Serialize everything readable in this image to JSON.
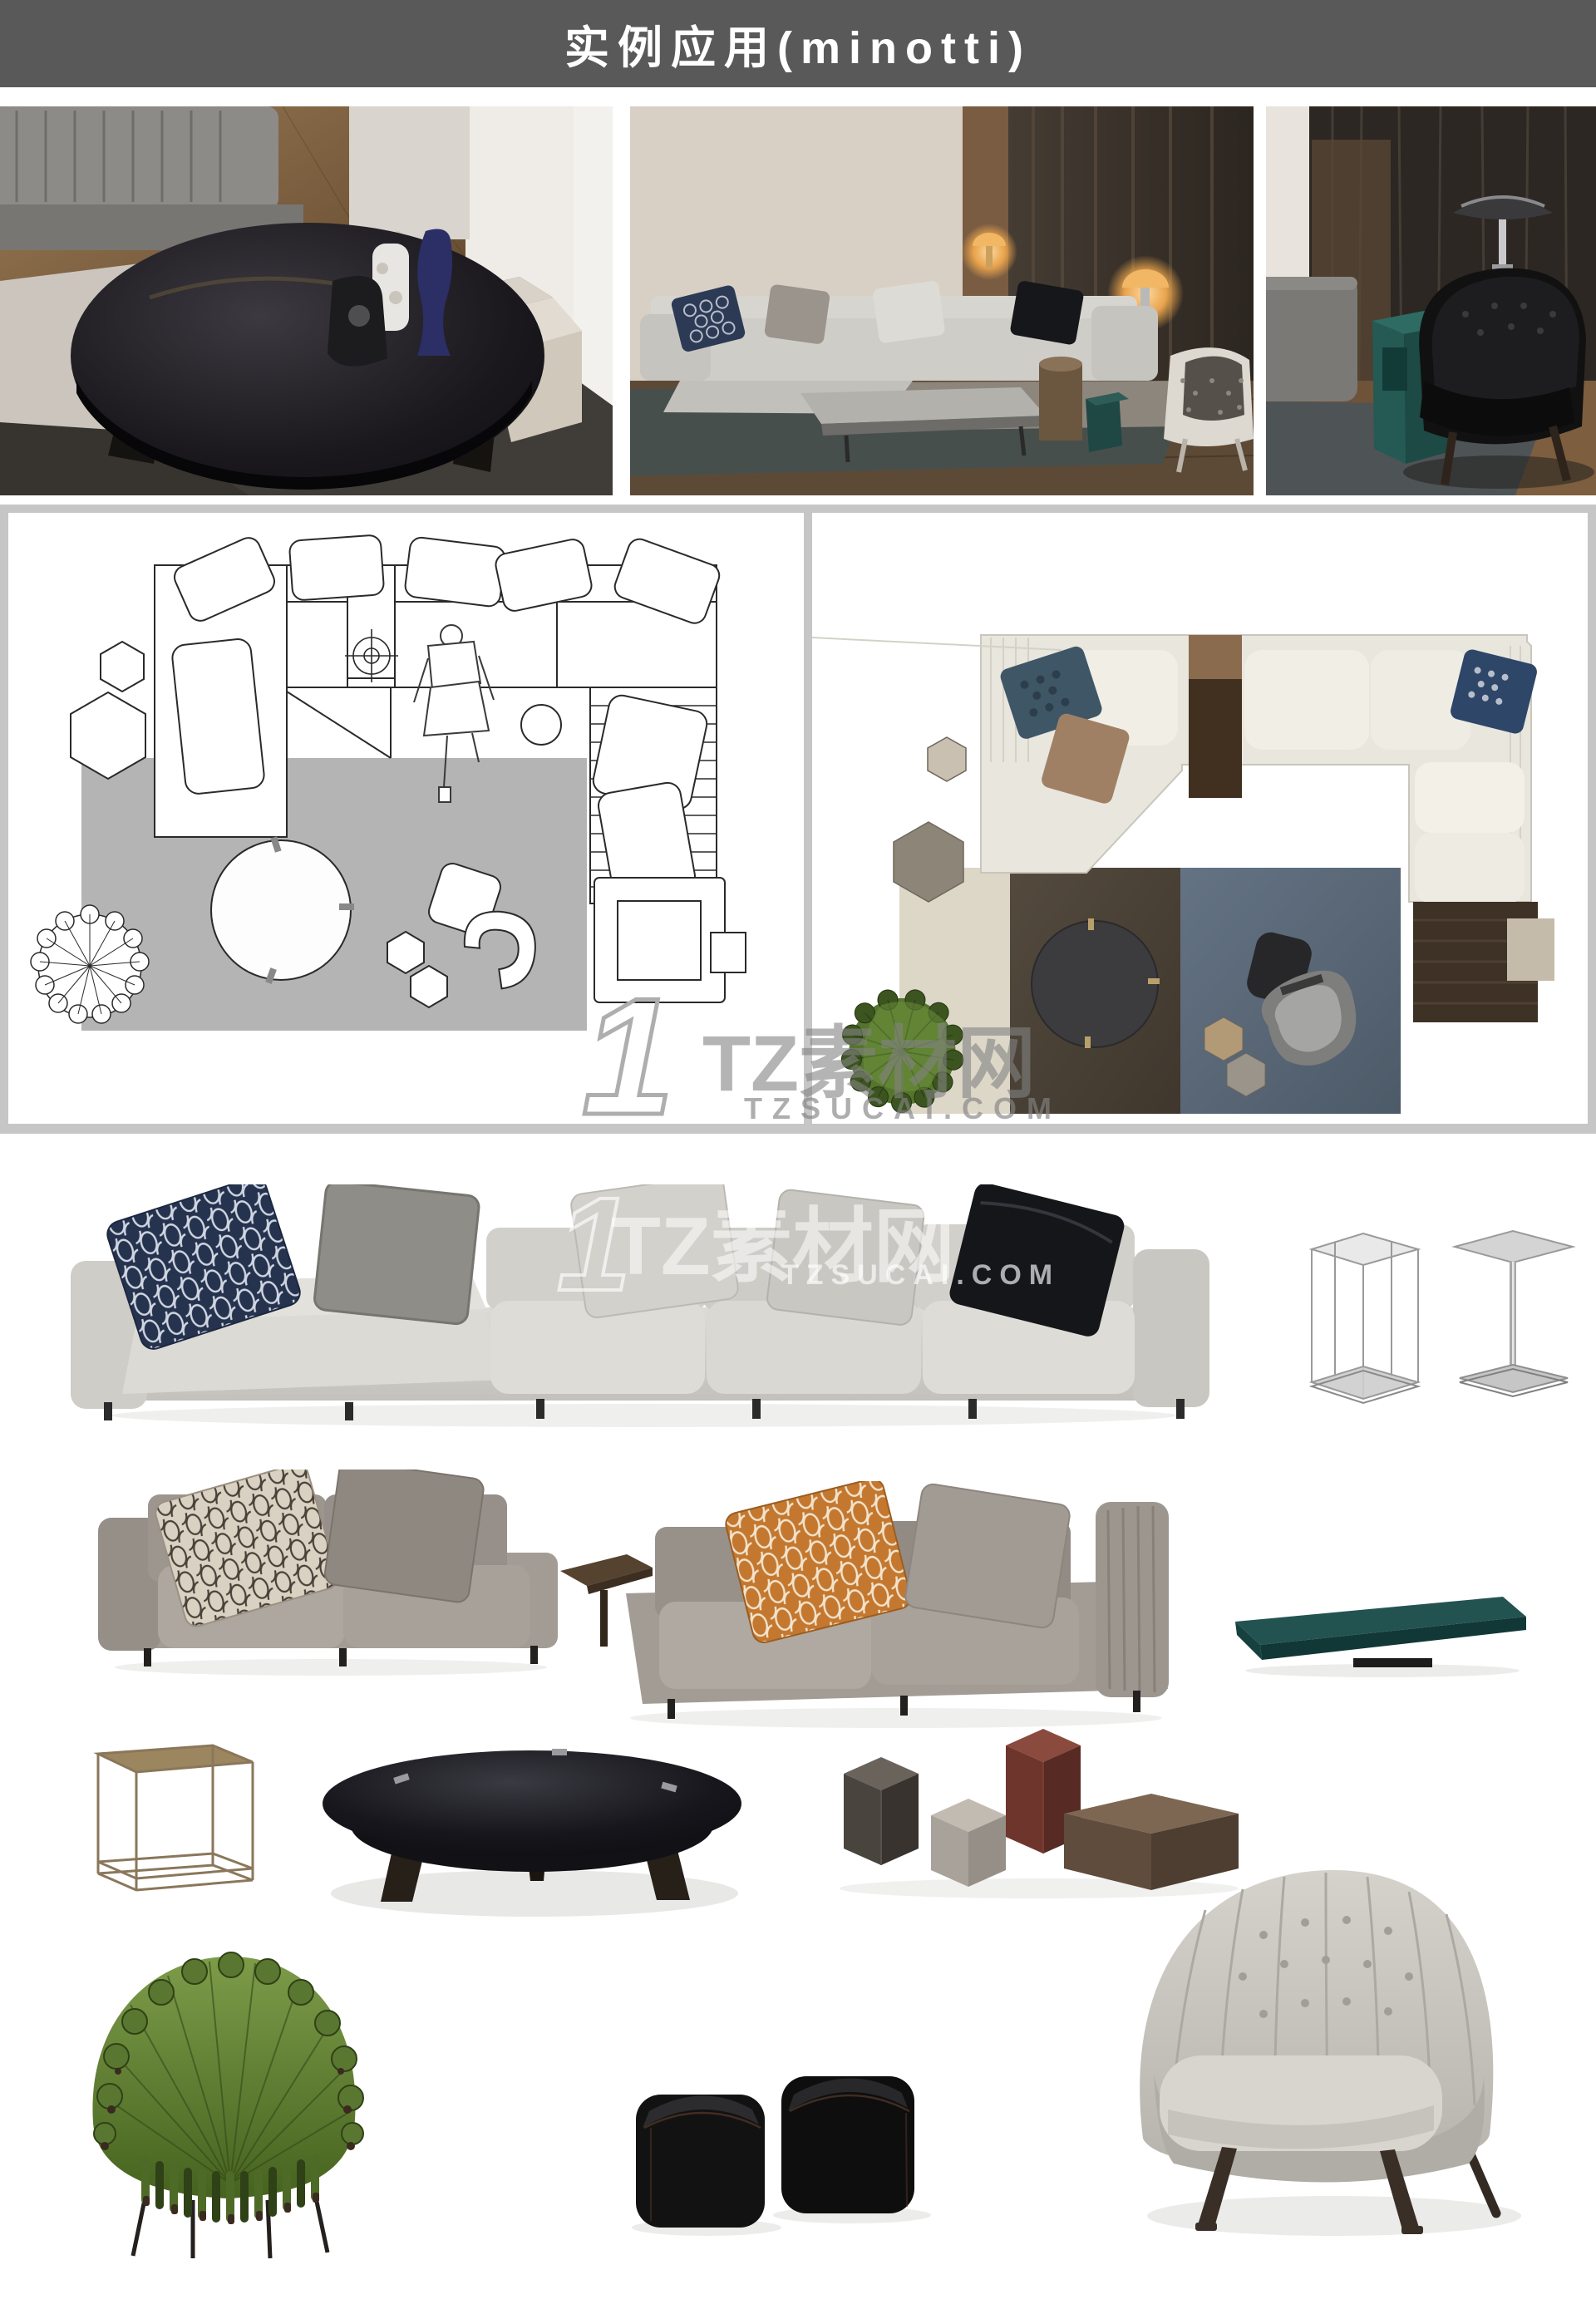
{
  "header": {
    "title": "实例应用(minotti)",
    "bg_color": "#59595a",
    "text_color": "#ffffff"
  },
  "watermark": {
    "logo_glyph": "1",
    "site_name": "TZ素材网",
    "site_url": "TZSUCAI.COM"
  },
  "sections": {
    "photos": [
      "minotti-coffee-table-room-photo",
      "minotti-sectional-sofa-room-photo",
      "minotti-leather-armchair-room-photo"
    ],
    "floor_plans": [
      "cad-line-floor-plan",
      "rendered-color-floor-plan"
    ],
    "furniture": [
      "light-gray-sectional-sofa",
      "hexagonal-wire-side-table",
      "chrome-pedestal-side-table",
      "gray-two-seat-sofa",
      "dark-wood-corner-table",
      "gray-sofa-with-orange-pillow",
      "teal-lacquer-coffee-table",
      "bronze-frame-side-table",
      "round-black-glass-coffee-table",
      "glossy-gray-hex-pedestal",
      "light-gray-hex-pedestal",
      "burgundy-hex-pedestal",
      "wood-hex-pedestal",
      "green-peacock-armchair",
      "black-leather-poufs",
      "tufted-fabric-armchair"
    ]
  },
  "colors": {
    "header_bg": "#59595a",
    "frame_gray": "#c6c6c6",
    "watermark_gray": "#a7a7a7",
    "watermark_white": "rgba(255,255,255,0.6)",
    "teal_table": "#1d4a48",
    "burgundy_hex": "#6e352c",
    "wood_hex": "#5f4c3c",
    "peacock_green": "#5d8030",
    "plan_rug_gray": "#b4b4b4",
    "plan_rug_cream": "#ddd7c8",
    "plan_rug_brown": "#4b4237",
    "plan_rug_blue": "#5a6878"
  }
}
